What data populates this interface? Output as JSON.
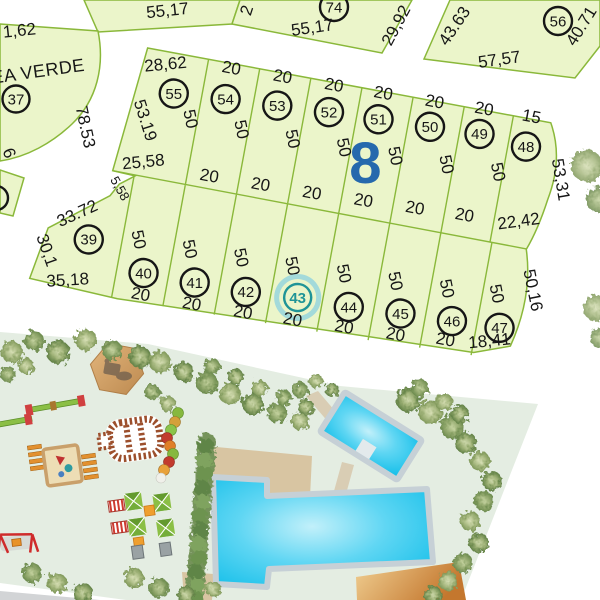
{
  "top_lots": {
    "lot_a": {
      "bottom": "55,17"
    },
    "lot_74": {
      "number": "74",
      "bottom": "55,17",
      "right": "29,92",
      "left_partial": "2"
    },
    "lot_56": {
      "number": "56",
      "left": "43.63",
      "bottom": "57,57",
      "right": "40.71"
    }
  },
  "area_verde": {
    "label": "ÁREA VERDE",
    "lot_number": "37",
    "left": "1,62",
    "arc": "78.53",
    "edge": "6"
  },
  "block8": {
    "number": "8",
    "upper": {
      "lots": [
        {
          "number": "55",
          "top": "28,62",
          "side": "53.19",
          "bottom": "25,58"
        },
        {
          "number": "54",
          "top": "20",
          "side": "50",
          "bottom": "20"
        },
        {
          "number": "53",
          "top": "20",
          "side": "50",
          "bottom": "20"
        },
        {
          "number": "52",
          "top": "20",
          "side": "50",
          "bottom": "20"
        },
        {
          "number": "51",
          "top": "20",
          "side": "50",
          "bottom": "20"
        },
        {
          "number": "50",
          "top": "20",
          "side": "50",
          "bottom": "20"
        },
        {
          "number": "49",
          "top": "20",
          "side": "50",
          "bottom": "20"
        },
        {
          "number": "48",
          "top": "15",
          "side": "50",
          "right": "53,31",
          "bottom": "22,42"
        }
      ]
    },
    "lower": {
      "selected_lot": "43",
      "lots": [
        {
          "number": "39",
          "top": "5,58",
          "upper_left": "33.72",
          "left": "30,1",
          "bottom": "35,18"
        },
        {
          "number": "40",
          "side": "50",
          "bottom": "20"
        },
        {
          "number": "41",
          "side": "50",
          "bottom": "20"
        },
        {
          "number": "42",
          "side": "50",
          "bottom": "20"
        },
        {
          "number": "43",
          "side": "50",
          "bottom": "20",
          "selected": true
        },
        {
          "number": "44",
          "side": "50",
          "bottom": "20"
        },
        {
          "number": "45",
          "side": "50",
          "bottom": "20"
        },
        {
          "number": "46",
          "side": "50",
          "bottom": "20"
        },
        {
          "number": "47",
          "side": "50",
          "right": "50,16",
          "bottom": "18,41"
        }
      ]
    }
  },
  "park": {
    "features": [
      "gazebo-hexagon",
      "picnic-table",
      "seesaw",
      "seesaw",
      "bench",
      "bench",
      "sandbox",
      "play-train-track",
      "caterpillar-toy",
      "swing-set",
      "playhouse",
      "slides",
      "hedge",
      "large-pool",
      "small-pool",
      "pool-steps",
      "walkway",
      "pool-deck",
      "sun-deck",
      "tree-clusters",
      "road"
    ]
  },
  "colors": {
    "lot_fill": "#ebf5ca",
    "lot_border": "#8ab83a",
    "selected_teal": "#1f9497",
    "block_number_blue": "#2569ad",
    "park_background": "#e4ede2",
    "pool_cyan": "#0cbce8",
    "deck_tan": "#d8c5a2",
    "sun_deck_orange": "#c4772e"
  }
}
